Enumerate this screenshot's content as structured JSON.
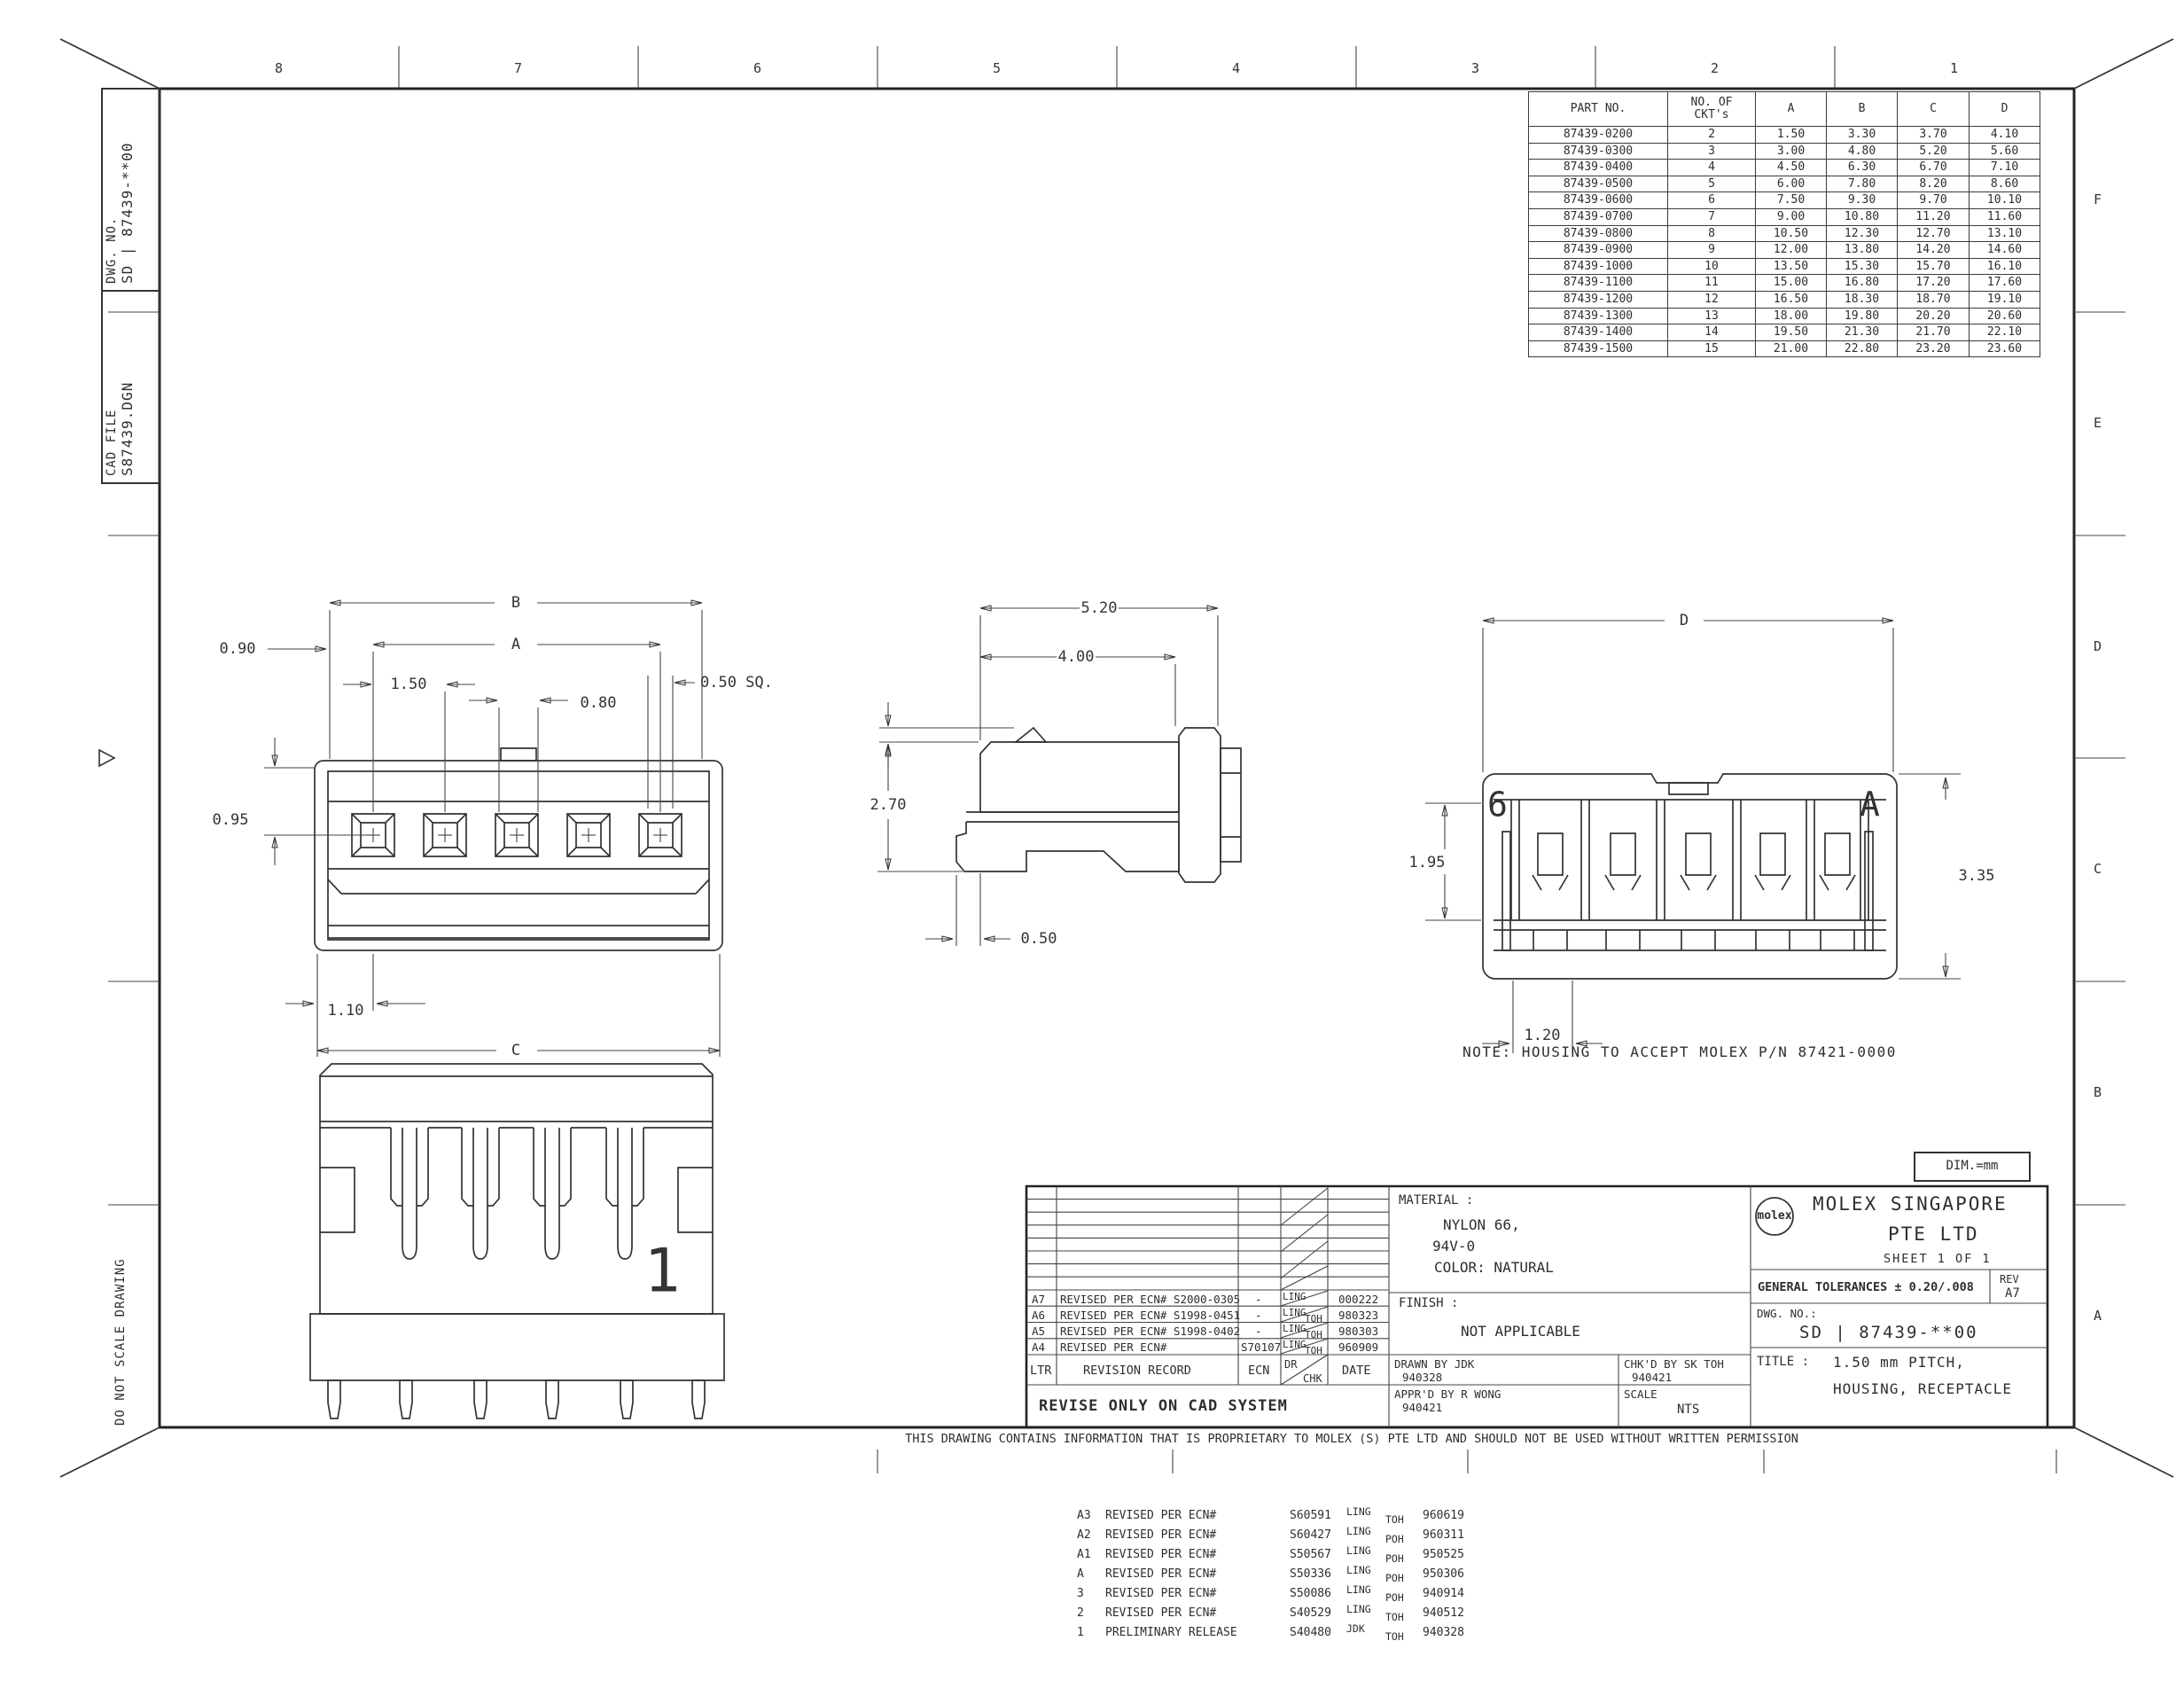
{
  "zones": {
    "top": [
      "8",
      "7",
      "6",
      "5",
      "4",
      "3",
      "2",
      "1"
    ],
    "right": [
      "F",
      "E",
      "D",
      "C",
      "B",
      "A"
    ]
  },
  "margin": {
    "dwg_no_label": "DWG. NO.",
    "dwg_no_value": "SD | 87439-**00",
    "cad_file_label": "CAD FILE",
    "cad_file_value": "S87439.DGN",
    "do_not_scale": "DO NOT SCALE DRAWING"
  },
  "part_table": {
    "headers": {
      "part": "PART NO.",
      "ckts1": "NO. OF",
      "ckts2": "CKT's",
      "a": "A",
      "b": "B",
      "c": "C",
      "d": "D"
    },
    "rows": [
      [
        "87439-0200",
        "2",
        "1.50",
        "3.30",
        "3.70",
        "4.10"
      ],
      [
        "87439-0300",
        "3",
        "3.00",
        "4.80",
        "5.20",
        "5.60"
      ],
      [
        "87439-0400",
        "4",
        "4.50",
        "6.30",
        "6.70",
        "7.10"
      ],
      [
        "87439-0500",
        "5",
        "6.00",
        "7.80",
        "8.20",
        "8.60"
      ],
      [
        "87439-0600",
        "6",
        "7.50",
        "9.30",
        "9.70",
        "10.10"
      ],
      [
        "87439-0700",
        "7",
        "9.00",
        "10.80",
        "11.20",
        "11.60"
      ],
      [
        "87439-0800",
        "8",
        "10.50",
        "12.30",
        "12.70",
        "13.10"
      ],
      [
        "87439-0900",
        "9",
        "12.00",
        "13.80",
        "14.20",
        "14.60"
      ],
      [
        "87439-1000",
        "10",
        "13.50",
        "15.30",
        "15.70",
        "16.10"
      ],
      [
        "87439-1100",
        "11",
        "15.00",
        "16.80",
        "17.20",
        "17.60"
      ],
      [
        "87439-1200",
        "12",
        "16.50",
        "18.30",
        "18.70",
        "19.10"
      ],
      [
        "87439-1300",
        "13",
        "18.00",
        "19.80",
        "20.20",
        "20.60"
      ],
      [
        "87439-1400",
        "14",
        "19.50",
        "21.30",
        "21.70",
        "22.10"
      ],
      [
        "87439-1500",
        "15",
        "21.00",
        "22.80",
        "23.20",
        "23.60"
      ]
    ]
  },
  "views": {
    "front": {
      "b": "B",
      "a": "A",
      "pitch": "1.50",
      "width": "0.80",
      "sq": "0.50 SQ.",
      "offset": "0.90",
      "height": "0.95",
      "first": "1.10",
      "c": "C"
    },
    "side": {
      "depth": "5.20",
      "depth2": "4.00",
      "ramp": "0.25",
      "height": "2.70",
      "foot": "0.50"
    },
    "rear": {
      "d": "D",
      "inner": "1.95",
      "overall": "3.35",
      "pitch": "1.20",
      "cav_left": "6",
      "cav_right": "A"
    },
    "bottom": {
      "one": "1"
    }
  },
  "note": "NOTE: HOUSING TO ACCEPT MOLEX P/N 87421-0000",
  "dim_box": "DIM.=mm",
  "title_block": {
    "material_label": "MATERIAL :",
    "material_1": "NYLON 66,",
    "material_2": "94V-0",
    "material_3": "COLOR: NATURAL",
    "finish_label": "FINISH :",
    "finish_value": "NOT APPLICABLE",
    "drawn_by": "DRAWN BY JDK",
    "drawn_date": "940328",
    "checked_by": "CHK'D BY SK TOH",
    "checked_date": "940421",
    "approved_by": "APPR'D BY R WONG",
    "approved_date": "940421",
    "scale_label": "SCALE",
    "scale_value": "NTS",
    "logo": "molex",
    "company_1": "MOLEX SINGAPORE",
    "company_2": "PTE LTD",
    "sheet": "SHEET 1 OF 1",
    "tolerances": "GENERAL TOLERANCES ± 0.20/.008",
    "rev_label": "REV",
    "rev_value": "A7",
    "dwg_no_label": "DWG. NO.:",
    "dwg_no_value": "SD | 87439-**00",
    "title_label": "TITLE :",
    "title_1": "1.50 mm PITCH,",
    "title_2": "HOUSING, RECEPTACLE"
  },
  "rev_table": {
    "header": {
      "ltr": "LTR",
      "record": "REVISION RECORD",
      "ecn": "ECN",
      "dr": "DR",
      "chk": "CHK",
      "date": "DATE"
    },
    "rows": [
      {
        "ltr": "A7",
        "desc": "REVISED PER ECN# S2000-0305",
        "ecn": "-",
        "dr": "LING",
        "chk": "",
        "date": "000222"
      },
      {
        "ltr": "A6",
        "desc": "REVISED PER ECN# S1998-0451",
        "ecn": "-",
        "dr": "LING",
        "chk": "TOH",
        "date": "980323"
      },
      {
        "ltr": "A5",
        "desc": "REVISED PER ECN# S1998-0402",
        "ecn": "-",
        "dr": "LING",
        "chk": "TOH",
        "date": "980303"
      },
      {
        "ltr": "A4",
        "desc": "REVISED PER ECN#",
        "ecn": "S70107",
        "dr": "LING",
        "chk": "TOH",
        "date": "960909"
      }
    ],
    "footer": "REVISE ONLY ON CAD SYSTEM"
  },
  "bottom_revisions": [
    {
      "ltr": "A3",
      "desc": "REVISED PER ECN#",
      "ecn": "S60591",
      "dr": "LING",
      "chk": "TOH",
      "date": "960619"
    },
    {
      "ltr": "A2",
      "desc": "REVISED PER ECN#",
      "ecn": "S60427",
      "dr": "LING",
      "chk": "POH",
      "date": "960311"
    },
    {
      "ltr": "A1",
      "desc": "REVISED PER ECN#",
      "ecn": "S50567",
      "dr": "LING",
      "chk": "POH",
      "date": "950525"
    },
    {
      "ltr": "A",
      "desc": "REVISED PER ECN#",
      "ecn": "S50336",
      "dr": "LING",
      "chk": "POH",
      "date": "950306"
    },
    {
      "ltr": "3",
      "desc": "REVISED PER ECN#",
      "ecn": "S50086",
      "dr": "LING",
      "chk": "POH",
      "date": "940914"
    },
    {
      "ltr": "2",
      "desc": "REVISED PER ECN#",
      "ecn": "S40529",
      "dr": "LING",
      "chk": "TOH",
      "date": "940512"
    },
    {
      "ltr": "1",
      "desc": "PRELIMINARY RELEASE",
      "ecn": "S40480",
      "dr": "JDK",
      "chk": "TOH",
      "date": "940328"
    }
  ],
  "proprietary": "THIS DRAWING CONTAINS INFORMATION THAT IS PROPRIETARY TO MOLEX (S) PTE LTD AND SHOULD NOT BE USED WITHOUT WRITTEN PERMISSION"
}
